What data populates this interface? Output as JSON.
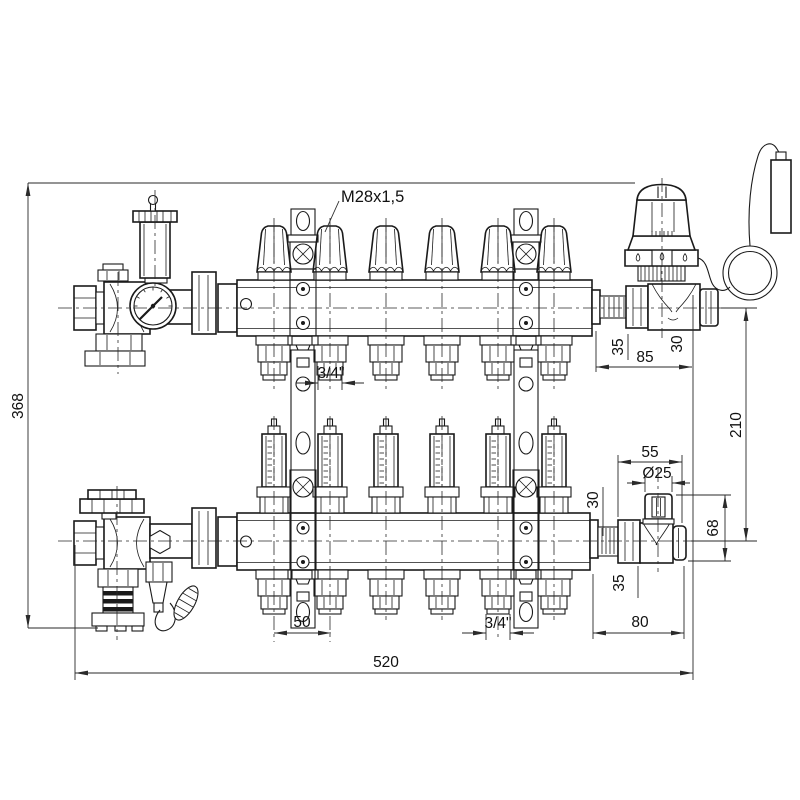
{
  "drawing": {
    "description": "manifold technical drawing",
    "callouts": {
      "valve_thread": "M28x1,5"
    },
    "dimensions": {
      "overall_height": "368",
      "overall_width": "520",
      "outlet_spacing": "50",
      "outlet_thread_top": "3/4\"",
      "outlet_thread_bottom": "3/4\"",
      "upper_valve_union_length": "35",
      "upper_valve_total_length": "85",
      "upper_valve_nut_length": "30",
      "manifold_axis_distance": "210",
      "lower_valve_width": "55",
      "handwheel_diameter": "Ø25",
      "lower_valve_height": "68",
      "lower_valve_stub_length": "30",
      "lower_valve_union_length": "35",
      "lower_valve_total_length": "80"
    },
    "colors": {
      "line": "#1a1a1a",
      "dimension": "#2a2a2a",
      "background": "#ffffff"
    }
  }
}
